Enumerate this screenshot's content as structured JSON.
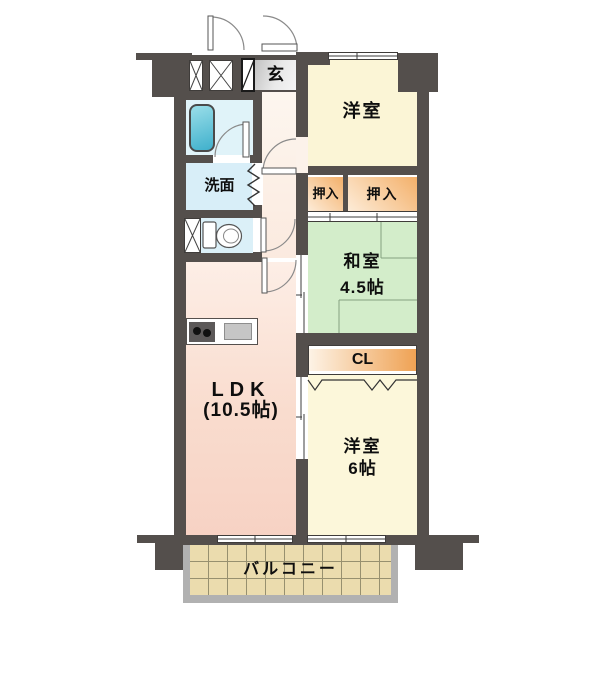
{
  "labels": {
    "entrance": "玄",
    "bedroom_north": "洋室",
    "closet_left": "押入",
    "closet_right": "押入",
    "japanese_room": "和室",
    "japanese_room_size": "4.5帖",
    "closet_cl": "CL",
    "washroom": "洗面",
    "ldk": "LDK",
    "ldk_size": "(10.5帖)",
    "bedroom_south": "洋室",
    "bedroom_south_size": "6帖",
    "balcony": "バルコニー"
  },
  "colors": {
    "wall": "#544f4c",
    "bedroom_fill": "#fbf5d6",
    "japanese_room_fill": "#d3edca",
    "closet_orange": "#f2ae62",
    "closet_light": "#fdecd8",
    "ldk_fill": "#f8d6c8",
    "hall_fill": "#fcf1e8",
    "bath_fill": "#e0f3f9",
    "washroom_fill": "#d8eef8",
    "toilet_fill": "#dbf0f8",
    "genkan_gray": "#d9d9d9",
    "balcony_floor": "#ebdcae",
    "balcony_rail": "#b1b1b1",
    "bathtub_teal": "#54bcd4"
  }
}
